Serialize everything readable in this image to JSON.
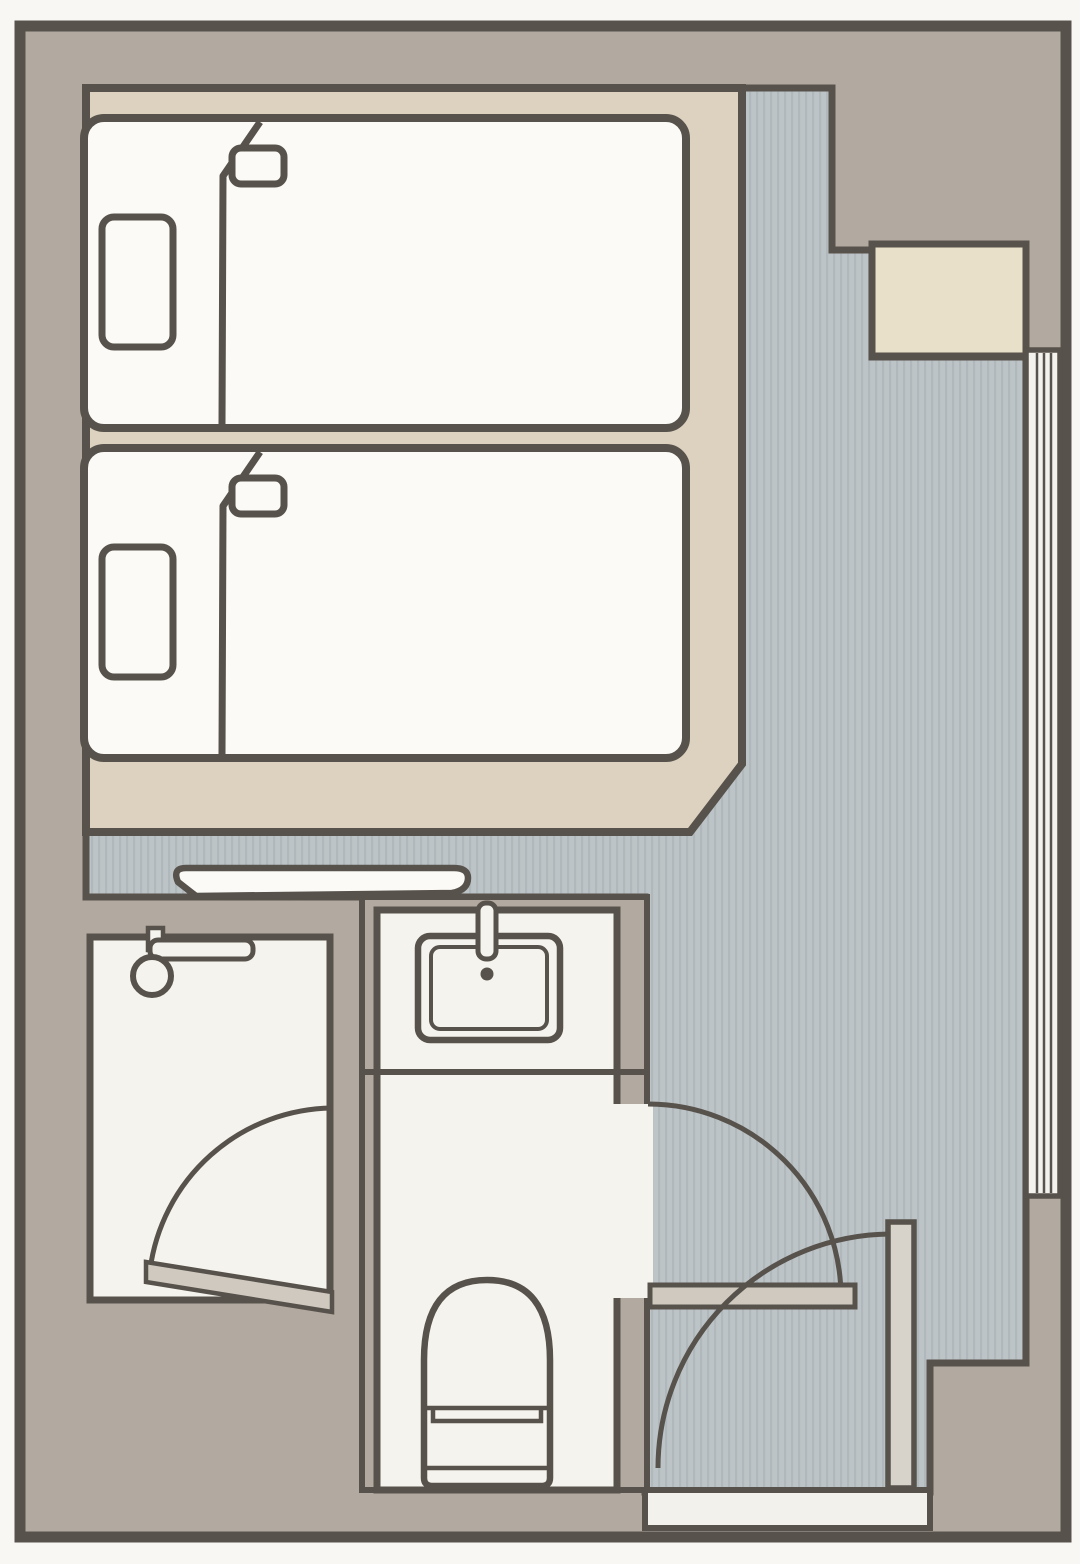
{
  "document": {
    "kind": "floor-plan",
    "room_type": "twin hotel room",
    "visible_text": []
  },
  "colors": {
    "page": "#f8f7f4",
    "line": "#57524b",
    "wall": "#b2a9a0",
    "carpet": "#ddd2c0",
    "closet": "#e9e0ca",
    "floor": "#bdc4c7",
    "floor_stripe": "#b0b8bc",
    "room": "#f5f3ed",
    "bed": "#fbfaf6",
    "door_leaf": "#cfc9c0",
    "threshold": "#f3f1eb",
    "window": "#f4f2ec",
    "door_jamb": "#d7d3cb"
  },
  "elements": [
    {
      "name": "outer-walls",
      "type": "structure"
    },
    {
      "name": "carpet-area",
      "type": "flooring"
    },
    {
      "name": "corridor-floor",
      "type": "flooring",
      "texture": "vertical-stripes"
    },
    {
      "name": "bed-1",
      "type": "furniture",
      "parts": [
        "pillow",
        "folded-blanket"
      ]
    },
    {
      "name": "bed-2",
      "type": "furniture",
      "parts": [
        "pillow",
        "folded-blanket"
      ]
    },
    {
      "name": "desk-console",
      "type": "furniture"
    },
    {
      "name": "closet",
      "type": "storage"
    },
    {
      "name": "window-right",
      "type": "window",
      "panes": 3
    },
    {
      "name": "shower-room",
      "type": "room",
      "fixtures": [
        "shower-head",
        "swing-door"
      ]
    },
    {
      "name": "toilet-room",
      "type": "room",
      "fixtures": [
        "sink",
        "faucet",
        "toilet",
        "swing-door"
      ]
    },
    {
      "name": "entrance",
      "type": "door",
      "parts": [
        "door-jamb-leaf",
        "swing-arc",
        "threshold"
      ]
    }
  ]
}
